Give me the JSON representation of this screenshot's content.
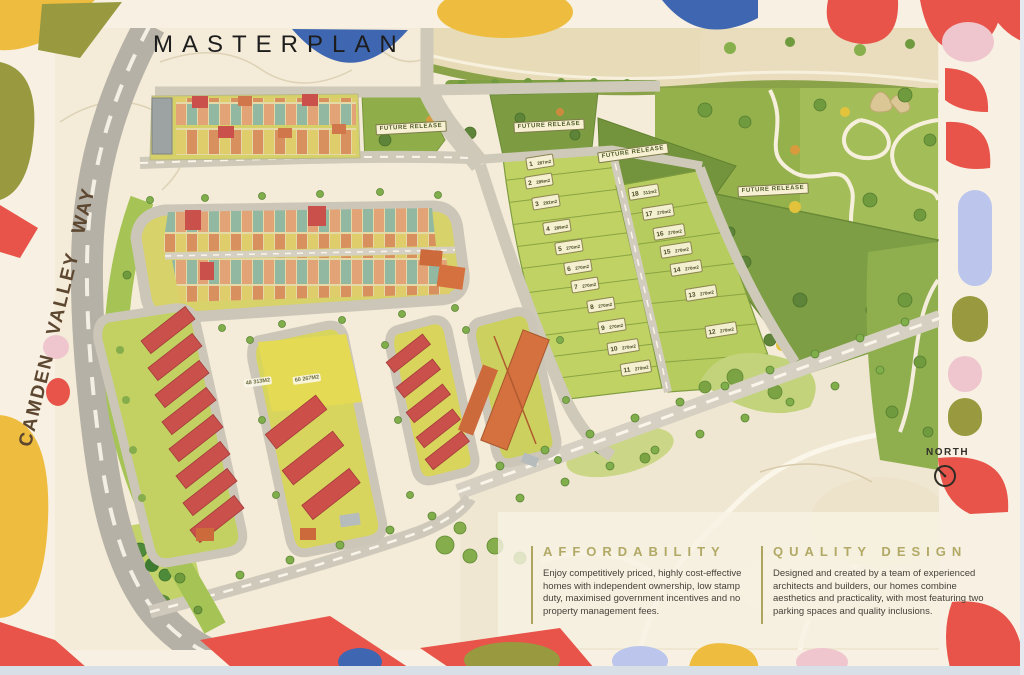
{
  "header": {
    "title": "MASTERPLAN"
  },
  "map": {
    "road_label": "CAMDEN VALLEY WAY",
    "north_label": "NORTH",
    "future_release_labels": [
      "FUTURE RELEASE",
      "FUTURE RELEASE",
      "FUTURE RELEASE",
      "FUTURE RELEASE"
    ],
    "area_labels": [
      "48 313M2",
      "60 267M2"
    ],
    "lots": [
      {
        "n": "1",
        "size": "287m2"
      },
      {
        "n": "2",
        "size": "289m2"
      },
      {
        "n": "3",
        "size": "292m2"
      },
      {
        "n": "4",
        "size": "289m2"
      },
      {
        "n": "5",
        "size": "270m2"
      },
      {
        "n": "6",
        "size": "270m2"
      },
      {
        "n": "7",
        "size": "270m2"
      },
      {
        "n": "8",
        "size": "270m2"
      },
      {
        "n": "9",
        "size": "270m2"
      },
      {
        "n": "10",
        "size": "270m2"
      },
      {
        "n": "11",
        "size": "270m2"
      },
      {
        "n": "12",
        "size": "270m2"
      },
      {
        "n": "13",
        "size": "270m2"
      },
      {
        "n": "14",
        "size": "270m2"
      },
      {
        "n": "15",
        "size": "270m2"
      },
      {
        "n": "16",
        "size": "270m2"
      },
      {
        "n": "17",
        "size": "270m2"
      },
      {
        "n": "18",
        "size": "311m2"
      }
    ]
  },
  "sections": {
    "affordability": {
      "heading": "AFFORDABILITY",
      "body": "Enjoy competitively priced, highly cost-effective homes with independent ownership, low stamp duty, maximised government incentives and no property management fees."
    },
    "quality_design": {
      "heading": "QUALITY DESIGN",
      "body": "Designed and created by a team of experienced architects and builders, our homes combine aesthetics and practicality, with most featuring two parking spaces and quality inclusions."
    }
  },
  "colors": {
    "map_cream": "#f4ebd8",
    "border_cream": "#f8f1e3",
    "accent_yellow": "#eebd3f",
    "accent_red": "#e8544a",
    "accent_olive": "#99993f",
    "accent_blue": "#3f67b1",
    "accent_pink": "#efc6ce",
    "accent_lavender": "#bcc6ec",
    "heading_olive": "#b1a965",
    "roof_red": "#c9504b",
    "roof_orange": "#d4713f"
  }
}
